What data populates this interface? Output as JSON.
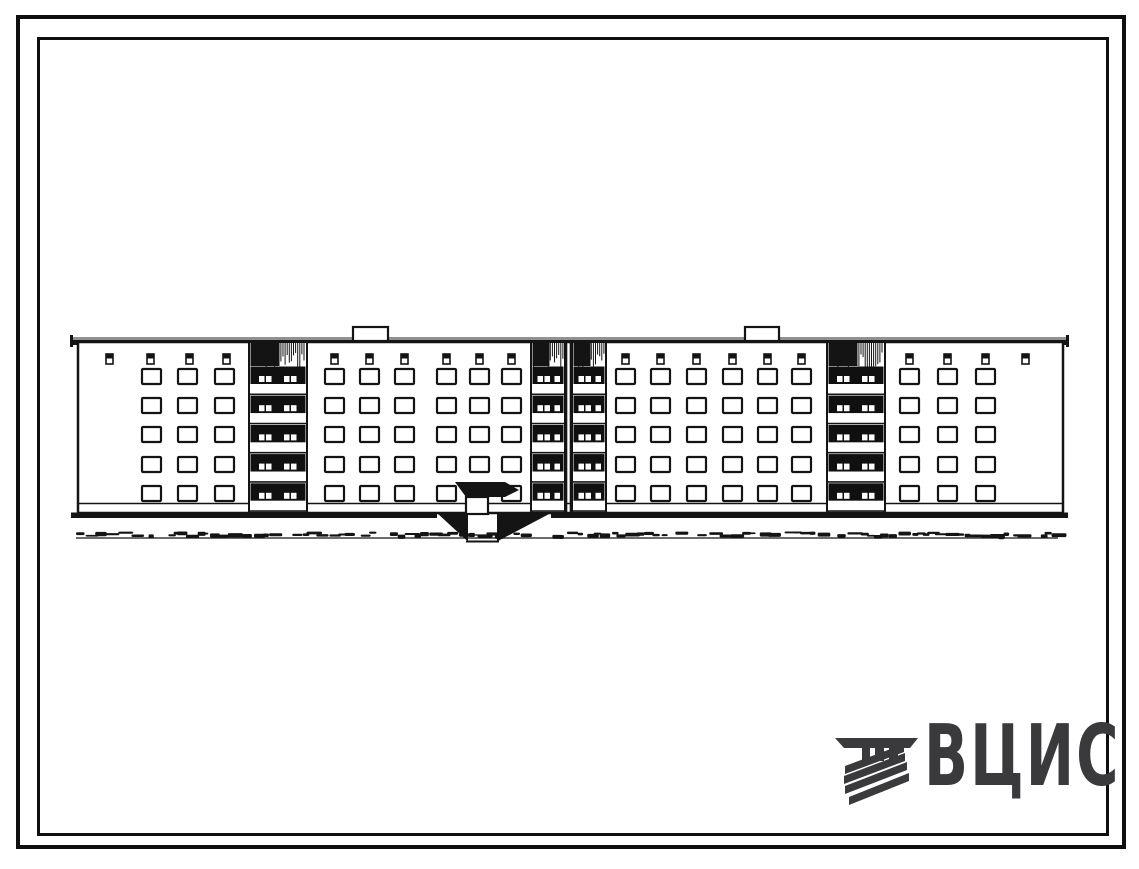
{
  "page": {
    "background": "#ffffff",
    "frame_color": "#0f0f0f",
    "description": "Scanned architectural sheet: front elevation of a 5-storey large-panel apartment block with four balcony (loggia) stacks, an expansion joint in the middle, a canopied entrance with sunken approach, ground line with grass, double drawing border and VCIS watermark logo"
  },
  "drawing": {
    "ink": "#141414",
    "building": {
      "left": 78,
      "right": 1063,
      "body_top": 342,
      "body_bottom": 513,
      "plinth_y": 503.5,
      "parapet": {
        "left": 71,
        "right": 1068,
        "gray_y": 337,
        "black_y": 340,
        "thickness": 5
      },
      "window": {
        "w": 19,
        "h": 15,
        "row_ys": [
          369,
          398,
          427,
          457,
          486
        ]
      },
      "vent": {
        "w": 7,
        "h": 10,
        "y": 354
      },
      "roof_boxes": [
        {
          "x": 353,
          "y": 327,
          "w": 35,
          "h": 14
        },
        {
          "x": 745,
          "y": 327,
          "w": 34,
          "h": 14
        }
      ],
      "wall_sections": [
        {
          "window_cols": [
            142,
            178,
            215
          ],
          "vent_cols": [
            106,
            147,
            186,
            223
          ]
        },
        {
          "window_cols": [
            325,
            360,
            395,
            437,
            470,
            502
          ],
          "vent_cols": [
            331,
            366,
            401,
            443,
            476,
            508
          ],
          "skip": {
            "col": 4,
            "row": 4
          }
        },
        {
          "window_cols": [
            616,
            651,
            687,
            723,
            758,
            792
          ],
          "vent_cols": [
            622,
            657,
            693,
            729,
            764,
            798
          ]
        },
        {
          "window_cols": [
            900,
            938,
            976
          ],
          "vent_cols": [
            906,
            944,
            982,
            1022
          ]
        }
      ],
      "loggias": [
        {
          "x": 249,
          "w": 58,
          "slots": [
            10,
            17,
            35,
            42
          ]
        },
        {
          "x": 531,
          "w": 34,
          "slots": [
            6.5,
            13.5,
            23.5
          ]
        },
        {
          "x": 572,
          "w": 34,
          "slots": [
            6.5,
            13.5,
            23.5
          ]
        },
        {
          "x": 827,
          "w": 58,
          "slots": [
            10,
            17,
            35,
            42
          ]
        }
      ],
      "balcony": {
        "first_band_y": 384,
        "pitch": 29.2,
        "band_h": 9.5,
        "dark_h": 17.5,
        "slot_w": 5.5,
        "slot_h": 6,
        "hatch_h": 23
      },
      "joint": {
        "x1": 566.5,
        "x2": 570.5
      },
      "entrance": {
        "canopy_points": "455,482 505,482 519,490 505,497 466,497",
        "door": {
          "x": 466,
          "y": 497,
          "w": 22,
          "h": 17
        },
        "pit": {
          "left_bank": "437,513 468,513 468,541.5",
          "right_bank": "551,513 497,513 497,541.5",
          "bottom_y": 541.5,
          "step_y": 535,
          "walk_left": 468,
          "walk_right": 497,
          "break_left": 437,
          "break_right": 551
        }
      },
      "ground": {
        "y": 512.5,
        "thickness": 5.5,
        "left": 71,
        "right": 1068
      },
      "grass": {
        "y": 538,
        "left": 76,
        "right": 1058
      },
      "floors": 5
    }
  },
  "logo": {
    "text": "ВЦИС",
    "color": "#3a3a3c",
    "emblem": {
      "bar": "3,11 86,11 78,21 12,21",
      "posts": [
        {
          "x": 30,
          "y": 21,
          "w": 8,
          "h": 13
        },
        {
          "x": 43,
          "y": 21,
          "w": 9,
          "h": 13
        },
        {
          "x": 57,
          "y": 21,
          "w": 9,
          "h": 13
        }
      ],
      "stripes": [
        {
          "x1": 13,
          "y1": 39,
          "x2": 72,
          "y2": 17
        },
        {
          "x1": 12,
          "y1": 49,
          "x2": 73,
          "y2": 26
        },
        {
          "x1": 13,
          "y1": 59,
          "x2": 75,
          "y2": 35
        },
        {
          "x1": 17,
          "y1": 70,
          "x2": 77,
          "y2": 46
        }
      ],
      "stripe_thickness": 8
    }
  }
}
